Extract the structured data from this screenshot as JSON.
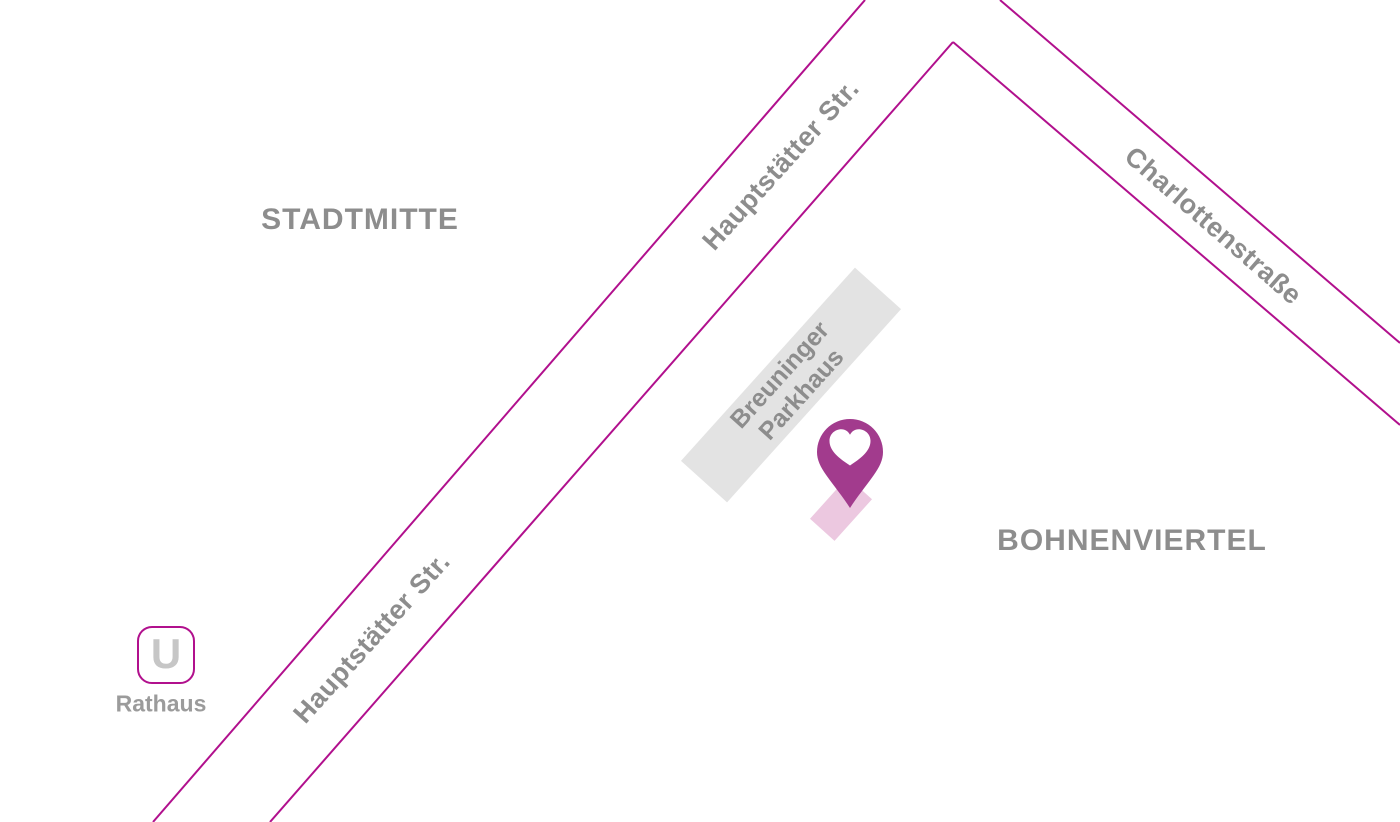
{
  "map": {
    "areas": [
      {
        "label": "STADTMITTE"
      },
      {
        "label": "BOHNENVIERTEL"
      }
    ],
    "streets": [
      {
        "label": "Hauptstätter Str."
      },
      {
        "label": "Hauptstätter Str."
      },
      {
        "label": "Charlottenstraße"
      }
    ],
    "building": {
      "line1": "Breuninger",
      "line2": "Parkhaus"
    },
    "station": {
      "symbol": "U",
      "name": "Rathaus"
    },
    "marker": {
      "icon": "heart-pin"
    },
    "colors": {
      "street_line": "#b1108d",
      "pin_fill": "#a23b8d",
      "label_gray": "#8d8d8d",
      "building_fill": "#e3e3e3",
      "footprint_fill": "#ecc8e0",
      "station_symbol_gray": "#c6c6c6"
    }
  }
}
